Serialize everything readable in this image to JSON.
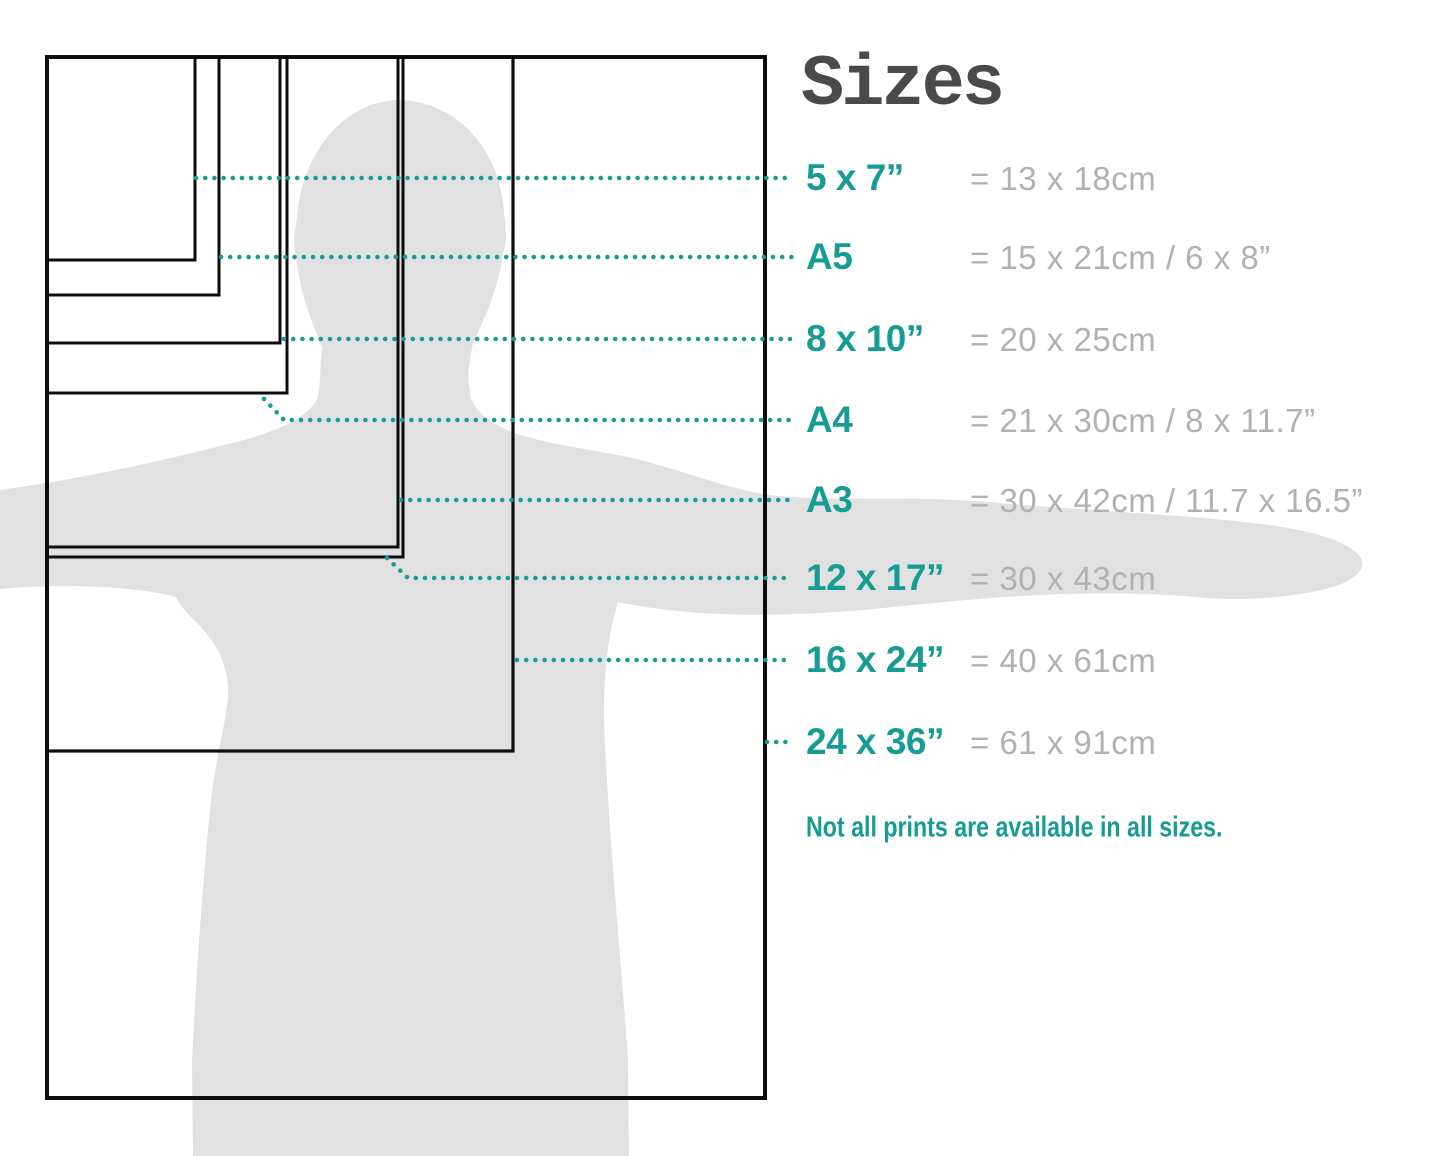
{
  "title": "Sizes",
  "note": "Not all prints are available in all sizes.",
  "colors": {
    "accent_teal": "#179c93",
    "value_gray": "#b1b1b1",
    "title_gray": "#4a4a4a",
    "outline_black": "#0d0d0d",
    "silhouette_gray": "#e1e1e1"
  },
  "diagram": {
    "origin": {
      "x": 47,
      "y": 57
    },
    "sizes": [
      {
        "label": "5 x 7”",
        "conversion": "= 13 x 18cm",
        "rect_w": 148,
        "rect_h": 203,
        "stroke": 3,
        "row_y": 178,
        "leader": [
          [
            196,
            178
          ],
          [
            792,
            178
          ]
        ]
      },
      {
        "label": "A5",
        "conversion": "= 15 x 21cm / 6 x 8”",
        "rect_w": 172,
        "rect_h": 238,
        "stroke": 3,
        "row_y": 257,
        "leader": [
          [
            221,
            257
          ],
          [
            792,
            257
          ]
        ]
      },
      {
        "label": "8 x 10”",
        "conversion": "= 20 x 25cm",
        "rect_w": 233,
        "rect_h": 286,
        "stroke": 3,
        "row_y": 339,
        "leader": [
          [
            284,
            339
          ],
          [
            792,
            339
          ]
        ]
      },
      {
        "label": "A4",
        "conversion": "= 21 x 30cm / 8 x 11.7”",
        "rect_w": 240,
        "rect_h": 336,
        "stroke": 3,
        "row_y": 420,
        "leader": [
          [
            264,
            399
          ],
          [
            284,
            420
          ],
          [
            792,
            420
          ]
        ]
      },
      {
        "label": "A3",
        "conversion": "= 30 x 42cm / 11.7 x 16.5”",
        "rect_w": 351,
        "rect_h": 490,
        "stroke": 3,
        "row_y": 500,
        "leader": [
          [
            401,
            500
          ],
          [
            792,
            500
          ]
        ]
      },
      {
        "label": "12 x 17”",
        "conversion": "= 30 x 43cm",
        "rect_w": 356,
        "rect_h": 500,
        "stroke": 3,
        "row_y": 578,
        "leader": [
          [
            387,
            558
          ],
          [
            408,
            578
          ],
          [
            792,
            578
          ]
        ]
      },
      {
        "label": "16 x 24”",
        "conversion": "= 40 x 61cm",
        "rect_w": 466,
        "rect_h": 694,
        "stroke": 3.2,
        "row_y": 660,
        "leader": [
          [
            517,
            660
          ],
          [
            792,
            660
          ]
        ]
      },
      {
        "label": "24 x 36”",
        "conversion": "= 61 x 91cm",
        "rect_w": 718,
        "rect_h": 1041,
        "stroke": 4,
        "row_y": 742,
        "leader": [
          [
            767,
            742
          ],
          [
            792,
            742
          ]
        ]
      }
    ]
  }
}
